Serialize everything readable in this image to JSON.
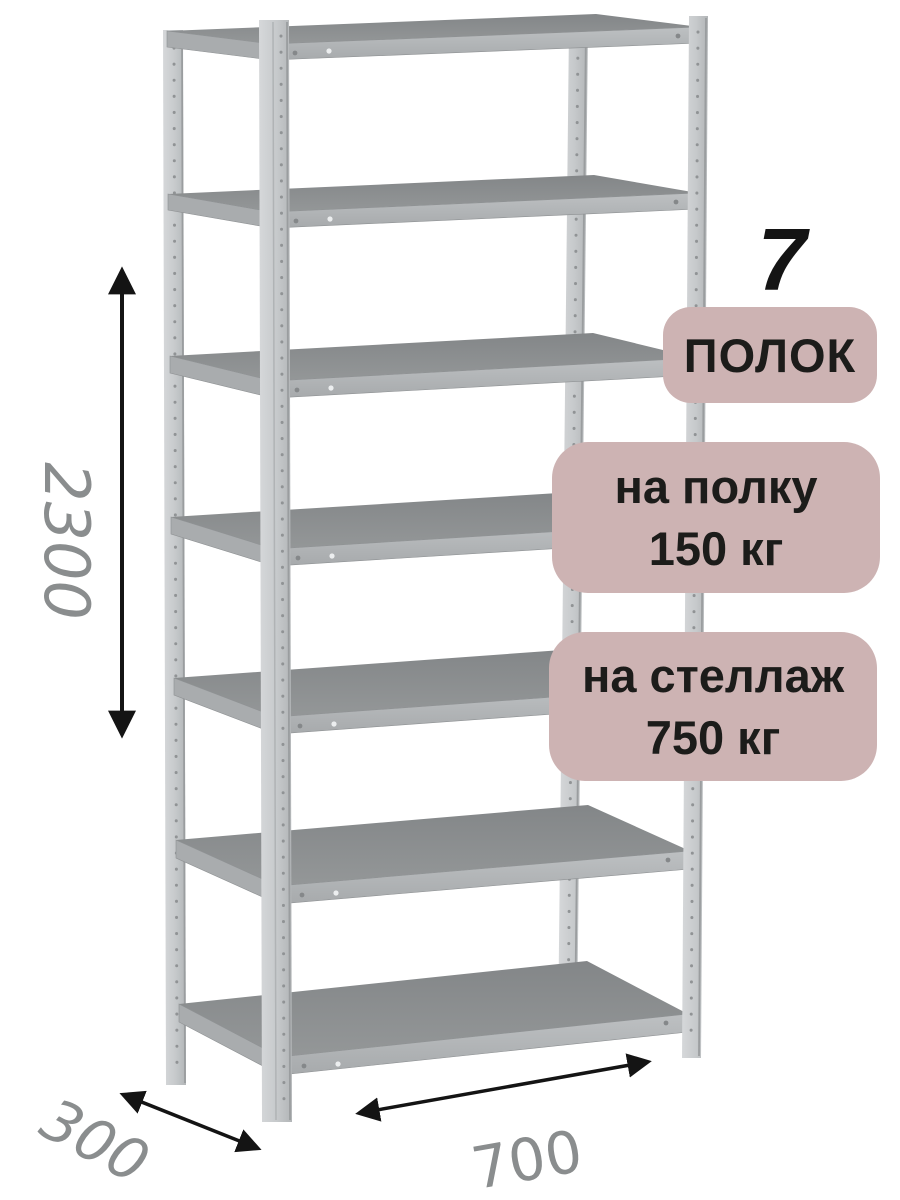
{
  "badges": {
    "shelf_count": {
      "value": "7",
      "label": "ПОЛОК"
    },
    "shelf_load": {
      "line1": "на полку",
      "line2": "150 кг"
    },
    "rack_load": {
      "line1": "на стеллаж",
      "line2": "750 кг"
    }
  },
  "dimensions": {
    "height": "2300",
    "depth": "300",
    "width": "700"
  },
  "rack": {
    "shelf_count": 7,
    "post_count": 4
  },
  "colors": {
    "badge_bg": "#cdb3b3",
    "badge_text": "#1c1c1a",
    "dimension_text": "#8a8d8e",
    "arrow": "#141414",
    "post_metal": "#c8cbcd",
    "shelf_top": "#8c8f91",
    "shelf_edge": "#b3b6b8"
  }
}
